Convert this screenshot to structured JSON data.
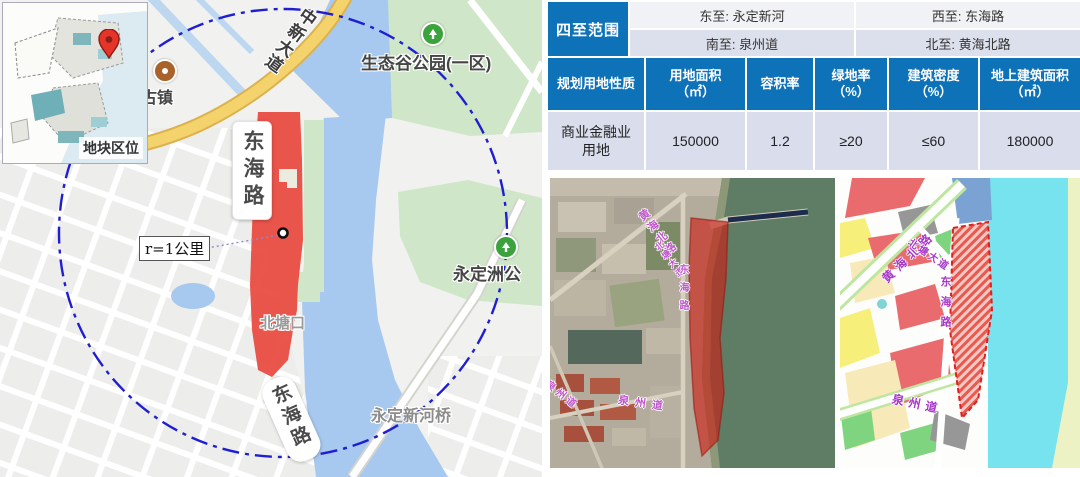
{
  "colors": {
    "table_blue": "#0E72B8",
    "parcel_red": "#E8473D",
    "circle_blue": "#1F1FD1",
    "road_label_purple": "#C055CC"
  },
  "map": {
    "inset_label": "地块区位",
    "zhongxin_avenue": "中新大道",
    "eco_park": "生态谷公园(一区)",
    "ancient_town": "古镇",
    "donghai_road_top": "东海路",
    "radius_label": "r=1公里",
    "beitangkou": "北塘口",
    "yongdingzhou_park": "永定洲公",
    "bridge": "永定新河桥",
    "donghai_road_bottom": "东海路"
  },
  "boundaries": {
    "title": "四至范围",
    "east": "东至: 永定新河",
    "west": "西至: 东海路",
    "south": "南至: 泉州道",
    "north": "北至: 黄海北路"
  },
  "plan_table": {
    "headers": [
      "规划用地性质",
      "用地面积\n（㎡）",
      "容积率",
      "绿地率\n（%）",
      "建筑密度\n（%）",
      "地上建筑面积\n（㎡）"
    ],
    "row": [
      "商业金融业\n用地",
      "150000",
      "1.2",
      "≥20",
      "≤60",
      "180000"
    ]
  },
  "satellite": {
    "huanghai_north_rd": "黄海北路",
    "beitang_ave": "北塘大道",
    "donghai_rd": "东海路",
    "quanzhou_rd": "泉州道",
    "quanzhou_rd_2": "泉州道"
  },
  "plan_map": {
    "huanghai_north_rd": "黄海北路",
    "beitang_ave": "北塘大道",
    "donghai_rd": "东海路",
    "quanzhou_rd": "泉州道"
  }
}
